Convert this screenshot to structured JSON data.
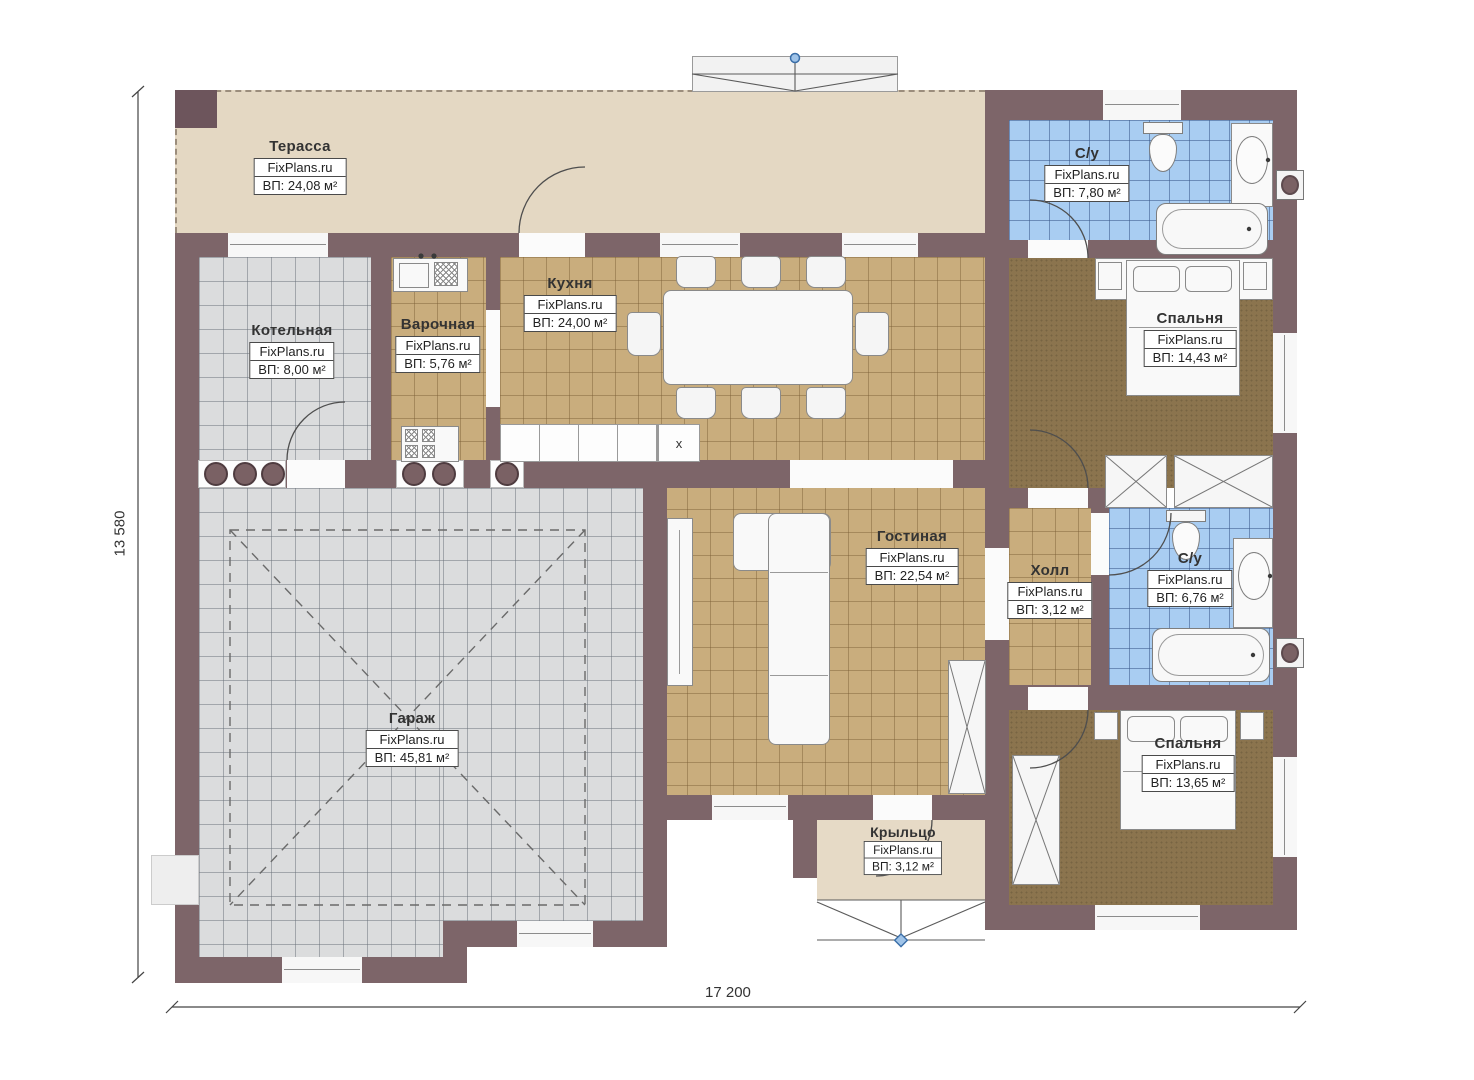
{
  "plan": {
    "watermark": "FixPlans.ru",
    "dimensions": {
      "width_label": "17 200",
      "height_label": "13 580"
    },
    "kitchen_counter_mark": "x",
    "colors": {
      "wall": "#7d6569",
      "terrace_floor": "#e4d8c3",
      "tile_tan": "#c9ad7d",
      "tile_gray": "#dbdcdd",
      "tile_blue": "#a9cdf2",
      "carpet_brown": "#8b744e",
      "marker_blue": "#4a7fb5"
    },
    "rooms": [
      {
        "id": "terrace",
        "name": "Терасса",
        "area": "ВП: 24,08 м²"
      },
      {
        "id": "boiler",
        "name": "Котельная",
        "area": "ВП: 8,00 м²"
      },
      {
        "id": "cooking",
        "name": "Варочная",
        "area": "ВП: 5,76 м²"
      },
      {
        "id": "kitchen",
        "name": "Кухня",
        "area": "ВП: 24,00 м²"
      },
      {
        "id": "bath1",
        "name": "С/у",
        "area": "ВП: 7,80 м²"
      },
      {
        "id": "bedroom1",
        "name": "Спальня",
        "area": "ВП: 14,43 м²"
      },
      {
        "id": "living",
        "name": "Гостиная",
        "area": "ВП: 22,54 м²"
      },
      {
        "id": "hall",
        "name": "Холл",
        "area": "ВП: 3,12 м²"
      },
      {
        "id": "bath2",
        "name": "С/у",
        "area": "ВП: 6,76 м²"
      },
      {
        "id": "garage",
        "name": "Гараж",
        "area": "ВП: 45,81 м²"
      },
      {
        "id": "bedroom2",
        "name": "Спальня",
        "area": "ВП: 13,65 м²"
      },
      {
        "id": "porch",
        "name": "Крыльцо",
        "area": "ВП: 3,12 м²"
      }
    ]
  }
}
